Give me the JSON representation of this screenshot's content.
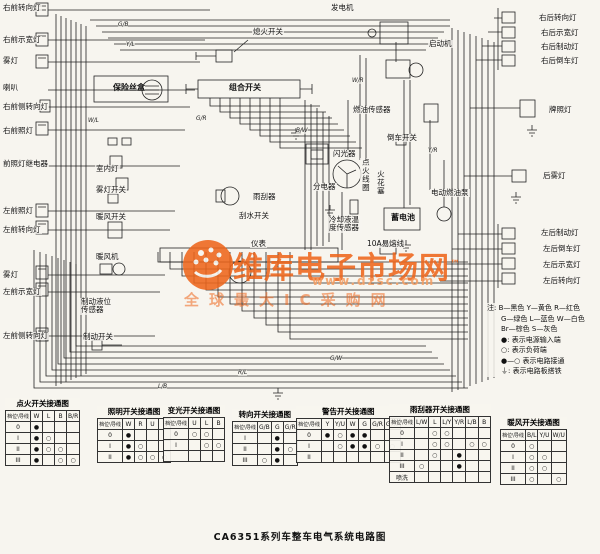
{
  "title": "CA6351系列车整车电气系统电路图",
  "watermark": {
    "brand": "维库电子市场网",
    "tm": "™",
    "url": "www.dzsc.com",
    "slogan": "全球最大IC采购网",
    "color": "#ee661c"
  },
  "legend": {
    "prefix": "注:",
    "color_lines": [
      "B—黑色  Y—黄色  R—红色",
      "G—绿色  L—蓝色  W—白色",
      "Br—棕色  S—灰色"
    ],
    "symbol_lines": [
      "●: 表示电源输入端",
      "○: 表示负荷端",
      "●—○ 表示电路接通",
      "⏚: 表示电路板搭铁"
    ]
  },
  "labels": {
    "rf_turn": "右前转向灯",
    "rf_marker": "右前示宽灯",
    "fog_front": "雾灯",
    "horn": "喇叭",
    "rf_side_turn": "右前侧转向灯",
    "rf_head": "右前照灯",
    "head_relay": "前照灯继电器",
    "lf_head": "左前照灯",
    "lf_turn": "左前转向灯",
    "fog_front2": "雾灯",
    "lf_marker": "左前示宽灯",
    "lf_side_turn": "左前侧转向灯",
    "fuse_box": "保险丝盒",
    "kill_switch": "熄火开关",
    "combo_switch": "组合开关",
    "generator": "发电机",
    "starter": "启动机",
    "flasher": "闪光器",
    "fuel_sensor": "燃油传感器",
    "reverse_switch": "倒车开关",
    "distributor": "分电器",
    "ignition_coil": "点火线圈",
    "spark_plug": "火花塞",
    "battery": "蓄电池",
    "coolant_sensor": "冷却液温度传感器",
    "fusible_link": "10A易熔线",
    "fuel_pump": "电动燃油泵",
    "interior_light": "室内灯",
    "fog_switch": "雾灯开关",
    "heater_switch": "暖风开关",
    "heater_fan": "暖风机",
    "brake_fluid_sensor": "制动液位传感器",
    "brake_switch": "制动开关",
    "instrument": "仪表",
    "wiper": "雨刮器",
    "wiper_switch": "刮水开关",
    "rr_turn": "右后转向灯",
    "rr_marker": "右后示宽灯",
    "rr_brake": "右后制动灯",
    "rr_reverse": "右后倒车灯",
    "plate": "牌照灯",
    "rear_fog": "后雾灯",
    "lr_brake": "左后制动灯",
    "lr_reverse": "左后倒车灯",
    "lr_marker": "左后示宽灯",
    "lr_turn": "左后转向灯"
  },
  "wire_codes": [
    "G/B",
    "Y/L",
    "G/R",
    "W/R",
    "B/W",
    "Y/R",
    "G/W",
    "R/L",
    "L/B",
    "W/L"
  ],
  "tables": [
    {
      "title": "点火开关接通图",
      "corner": "档位\\导线",
      "headers": [
        "W",
        "L",
        "B",
        "B/R"
      ],
      "rows": [
        [
          "0",
          "●",
          "",
          "",
          ""
        ],
        [
          "I",
          "●",
          "○",
          "",
          ""
        ],
        [
          "II",
          "●",
          "○",
          "○",
          ""
        ],
        [
          "III",
          "●",
          "",
          "○",
          "○"
        ]
      ]
    },
    {
      "title": "照明开关接通图",
      "corner": "档位\\导线",
      "headers": [
        "W",
        "R",
        "U",
        "B"
      ],
      "rows": [
        [
          "0",
          "●",
          "",
          "",
          ""
        ],
        [
          "I",
          "●",
          "○",
          "",
          ""
        ],
        [
          "II",
          "●",
          "○",
          "○",
          "○"
        ]
      ]
    },
    {
      "title": "变光开关接通图",
      "corner": "档位\\导线",
      "headers": [
        "U",
        "L",
        "B"
      ],
      "rows": [
        [
          "0",
          "○",
          "○",
          ""
        ],
        [
          "I",
          "",
          "○",
          "○"
        ],
        [
          "",
          "",
          "",
          ""
        ]
      ]
    },
    {
      "title": "转向开关接通图",
      "corner": "档位\\导线",
      "headers": [
        "G/B",
        "G",
        "G/R"
      ],
      "rows": [
        [
          "I",
          "",
          "●",
          ""
        ],
        [
          "II",
          "",
          "●",
          "○"
        ],
        [
          "III",
          "○",
          "●",
          ""
        ]
      ]
    },
    {
      "title": "警告开关接通图",
      "corner": "档位\\导线",
      "headers": [
        "Y",
        "Y/U",
        "W",
        "G",
        "G/R",
        "G/W"
      ],
      "rows": [
        [
          "0",
          "●",
          "○",
          "●",
          "●",
          "",
          ""
        ],
        [
          "I",
          "",
          "○",
          "●",
          "●",
          "○",
          "○"
        ],
        [
          "II",
          "",
          "",
          "",
          "",
          "",
          ""
        ]
      ]
    },
    {
      "title": "雨刮器开关接通图",
      "corner": "档位\\导线",
      "headers": [
        "L/W",
        "L",
        "L/Y",
        "Y/R",
        "L/B",
        "B"
      ],
      "rows": [
        [
          "0",
          "",
          "○",
          "○",
          "",
          "",
          ""
        ],
        [
          "I",
          "",
          "○",
          "○",
          "",
          "○",
          "○"
        ],
        [
          "II",
          "",
          "○",
          "",
          "●",
          "",
          ""
        ],
        [
          "III",
          "○",
          "",
          "",
          "●",
          "",
          ""
        ],
        [
          "喷洗",
          "",
          "",
          "",
          "",
          "",
          ""
        ]
      ]
    },
    {
      "title": "暖风开关接通图",
      "corner": "档位\\导线",
      "headers": [
        "B/L",
        "Y/U",
        "W/U"
      ],
      "rows": [
        [
          "0",
          "○",
          "",
          ""
        ],
        [
          "I",
          "○",
          "○",
          ""
        ],
        [
          "II",
          "○",
          "○",
          ""
        ],
        [
          "III",
          "○",
          "",
          "○"
        ]
      ]
    }
  ]
}
